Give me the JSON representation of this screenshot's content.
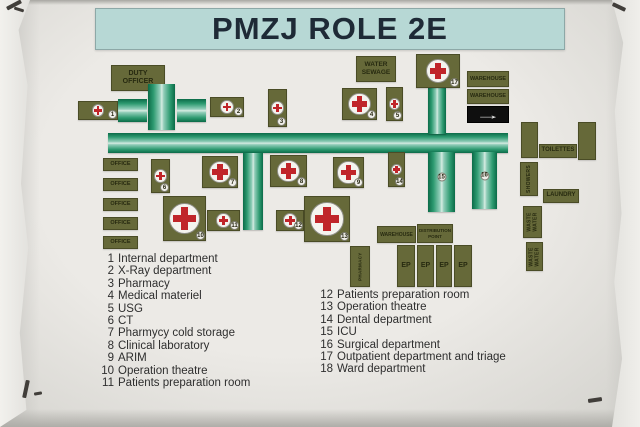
{
  "title": "PMZJ ROLE 2E",
  "colors": {
    "banner": "#b7d8d5",
    "olive": "#666939",
    "label_text": "#272a10",
    "red": "#c0252a",
    "green_dark": "#0b6b48",
    "green_light": "#d6ece2",
    "arrow_bg": "#0f0f0f",
    "arrow_fg": "#f5f5f5",
    "legend_text": "#2e2e2e"
  },
  "legend": {
    "left": [
      {
        "num": "1",
        "label": "Internal department"
      },
      {
        "num": "2",
        "label": "X-Ray department"
      },
      {
        "num": "3",
        "label": "Pharmacy"
      },
      {
        "num": "4",
        "label": "Medical materiel"
      },
      {
        "num": "5",
        "label": "USG"
      },
      {
        "num": "6",
        "label": "CT"
      },
      {
        "num": "7",
        "label": "Pharmycy cold storage"
      },
      {
        "num": "8",
        "label": "Clinical laboratory"
      },
      {
        "num": "9",
        "label": "ARIM"
      },
      {
        "num": "10",
        "label": "Operation theatre"
      },
      {
        "num": "11",
        "label": "Patients preparation room"
      }
    ],
    "right": [
      {
        "num": "12",
        "label": "Patients preparation room"
      },
      {
        "num": "13",
        "label": "Operation theatre"
      },
      {
        "num": "14",
        "label": "Dental department"
      },
      {
        "num": "15",
        "label": "ICU"
      },
      {
        "num": "16",
        "label": "Surgical department"
      },
      {
        "num": "17",
        "label": "Outpatient department and triage"
      },
      {
        "num": "18",
        "label": "Ward department"
      }
    ]
  },
  "map": {
    "arrow_glyph": "→",
    "items": [
      {
        "kind": "label",
        "name": "duty-officer-label",
        "x": 111,
        "y": 65,
        "w": 54,
        "h": 26,
        "text": "DUTY\nOFFICER",
        "fs": 7
      },
      {
        "kind": "label",
        "name": "water-sewage-label",
        "x": 356,
        "y": 56,
        "w": 40,
        "h": 26,
        "text": "WATER\nSEWAGE",
        "fs": 6.5
      },
      {
        "kind": "label",
        "name": "warehouse-label",
        "x": 467,
        "y": 71,
        "w": 42,
        "h": 16,
        "text": "WAREHOUSE",
        "fs": 5.5
      },
      {
        "kind": "label",
        "name": "warehouse-label",
        "x": 467,
        "y": 89,
        "w": 42,
        "h": 15,
        "text": "WAREHOUSE",
        "fs": 5.5
      },
      {
        "kind": "arrow",
        "name": "ambulance-entrance-arrow",
        "x": 467,
        "y": 106,
        "w": 42,
        "h": 17
      },
      {
        "kind": "green-h",
        "name": "corridor-segment",
        "x": 118,
        "y": 99,
        "w": 29,
        "h": 23
      },
      {
        "kind": "green-v",
        "name": "corridor-junction",
        "x": 148,
        "y": 84,
        "w": 27,
        "h": 46
      },
      {
        "kind": "green-h",
        "name": "corridor-segment",
        "x": 177,
        "y": 99,
        "w": 29,
        "h": 23
      },
      {
        "kind": "green-h",
        "name": "main-corridor",
        "x": 108,
        "y": 133,
        "w": 400,
        "h": 20
      },
      {
        "kind": "green-v",
        "name": "triage-corridor-stem",
        "x": 428,
        "y": 88,
        "w": 18,
        "h": 46
      },
      {
        "kind": "green-v",
        "name": "central-corridor",
        "x": 243,
        "y": 153,
        "w": 20,
        "h": 77
      },
      {
        "kind": "cross",
        "name": "tent-1-internal",
        "x": 78,
        "y": 101,
        "w": 40,
        "h": 19,
        "num": "1"
      },
      {
        "kind": "cross",
        "name": "tent-2-xray",
        "x": 210,
        "y": 97,
        "w": 34,
        "h": 20,
        "num": "2"
      },
      {
        "kind": "cross",
        "name": "tent-3-pharmacy",
        "x": 268,
        "y": 89,
        "w": 19,
        "h": 38,
        "num": "3"
      },
      {
        "kind": "cross",
        "name": "tent-4-medical-materiel",
        "x": 342,
        "y": 88,
        "w": 35,
        "h": 32,
        "num": "4"
      },
      {
        "kind": "cross",
        "name": "tent-5-usg",
        "x": 386,
        "y": 87,
        "w": 17,
        "h": 34,
        "num": "5"
      },
      {
        "kind": "cross",
        "name": "tent-17-outpatient-triage",
        "x": 416,
        "y": 54,
        "w": 44,
        "h": 34,
        "num": "17"
      },
      {
        "kind": "cross",
        "name": "tent-6-ct",
        "x": 151,
        "y": 159,
        "w": 19,
        "h": 34,
        "num": "6"
      },
      {
        "kind": "cross",
        "name": "tent-7-cold-storage",
        "x": 202,
        "y": 156,
        "w": 36,
        "h": 32,
        "num": "7"
      },
      {
        "kind": "cross",
        "name": "tent-8-laboratory",
        "x": 270,
        "y": 155,
        "w": 37,
        "h": 32,
        "num": "8"
      },
      {
        "kind": "cross",
        "name": "tent-9-arim",
        "x": 333,
        "y": 157,
        "w": 31,
        "h": 31,
        "num": "9"
      },
      {
        "kind": "cross",
        "name": "tent-14-dental",
        "x": 388,
        "y": 152,
        "w": 17,
        "h": 35,
        "num": "14"
      },
      {
        "kind": "cross",
        "name": "tent-10-operation-theatre",
        "x": 163,
        "y": 196,
        "w": 43,
        "h": 45,
        "num": "10"
      },
      {
        "kind": "cross",
        "name": "tent-11-patients-prep",
        "x": 207,
        "y": 210,
        "w": 33,
        "h": 21,
        "num": "11"
      },
      {
        "kind": "cross",
        "name": "tent-12-patients-prep",
        "x": 276,
        "y": 210,
        "w": 28,
        "h": 21,
        "num": "12"
      },
      {
        "kind": "cross",
        "name": "tent-13-operation-theatre",
        "x": 304,
        "y": 196,
        "w": 46,
        "h": 46,
        "num": "13"
      },
      {
        "kind": "green-v",
        "name": "tent-15-icu",
        "x": 428,
        "y": 152,
        "w": 27,
        "h": 60,
        "num": "15"
      },
      {
        "kind": "green-v",
        "name": "tent-16-surgical",
        "x": 472,
        "y": 152,
        "w": 25,
        "h": 57,
        "num": "16"
      },
      {
        "kind": "plain",
        "name": "toilet-block",
        "x": 521,
        "y": 122,
        "w": 17,
        "h": 36
      },
      {
        "kind": "label",
        "name": "toilettes-label",
        "x": 539,
        "y": 144,
        "w": 38,
        "h": 14,
        "text": "TOILETTES",
        "fs": 6
      },
      {
        "kind": "plain",
        "name": "toilet-block",
        "x": 578,
        "y": 122,
        "w": 18,
        "h": 38
      },
      {
        "kind": "label-rot",
        "name": "showers-label",
        "x": 520,
        "y": 162,
        "w": 18,
        "h": 34,
        "text": "SHOWERS",
        "fs": 5
      },
      {
        "kind": "label",
        "name": "laundry-label",
        "x": 543,
        "y": 189,
        "w": 36,
        "h": 14,
        "text": "LAUNDRY",
        "fs": 6
      },
      {
        "kind": "label-rot",
        "name": "waste-water-label",
        "x": 523,
        "y": 206,
        "w": 19,
        "h": 32,
        "text": "WASTE\nWATER",
        "fs": 5
      },
      {
        "kind": "label-rot",
        "name": "waste-water-label",
        "x": 526,
        "y": 242,
        "w": 17,
        "h": 29,
        "text": "WASTE\nWATER",
        "fs": 5
      },
      {
        "kind": "label",
        "name": "office-label",
        "x": 103,
        "y": 158,
        "w": 35,
        "h": 13,
        "text": "OFFICE",
        "fs": 5.5
      },
      {
        "kind": "label",
        "name": "office-label",
        "x": 103,
        "y": 178,
        "w": 35,
        "h": 13,
        "text": "OFFICE",
        "fs": 5.5
      },
      {
        "kind": "label",
        "name": "office-label",
        "x": 103,
        "y": 198,
        "w": 35,
        "h": 13,
        "text": "OFFICE",
        "fs": 5.5
      },
      {
        "kind": "label",
        "name": "office-label",
        "x": 103,
        "y": 217,
        "w": 35,
        "h": 13,
        "text": "OFFICE",
        "fs": 5.5
      },
      {
        "kind": "label",
        "name": "office-label",
        "x": 103,
        "y": 236,
        "w": 35,
        "h": 13,
        "text": "OFFICE",
        "fs": 5.5
      },
      {
        "kind": "label",
        "name": "warehouse-label",
        "x": 377,
        "y": 226,
        "w": 39,
        "h": 17,
        "text": "WAREHOUSE",
        "fs": 5
      },
      {
        "kind": "label",
        "name": "distribution-point-label",
        "x": 417,
        "y": 224,
        "w": 36,
        "h": 19,
        "text": "DISTRIBUTION\nPOINT",
        "fs": 4.5
      },
      {
        "kind": "label-rot",
        "name": "pharmacy-store-label",
        "x": 350,
        "y": 246,
        "w": 20,
        "h": 41,
        "text": "PHARMACY",
        "fs": 4.5
      },
      {
        "kind": "label",
        "name": "ep-box",
        "x": 397,
        "y": 245,
        "w": 18,
        "h": 42,
        "text": "EP",
        "fs": 7
      },
      {
        "kind": "label",
        "name": "ep-box",
        "x": 417,
        "y": 245,
        "w": 17,
        "h": 42,
        "text": "EP",
        "fs": 7
      },
      {
        "kind": "label",
        "name": "ep-box",
        "x": 436,
        "y": 245,
        "w": 16,
        "h": 42,
        "text": "EP",
        "fs": 7
      },
      {
        "kind": "label",
        "name": "ep-box",
        "x": 454,
        "y": 245,
        "w": 18,
        "h": 42,
        "text": "EP",
        "fs": 7
      }
    ]
  }
}
